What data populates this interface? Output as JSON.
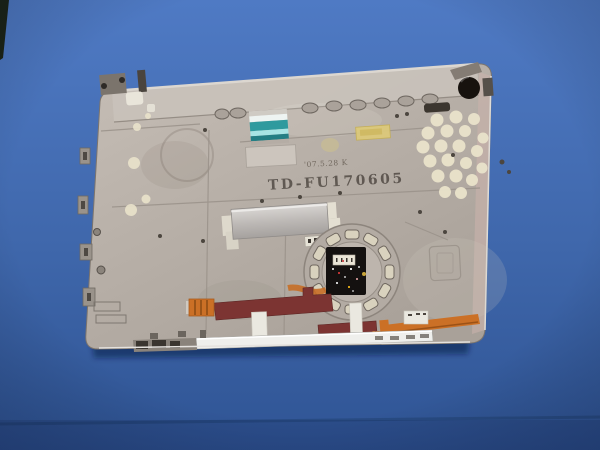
{
  "photo": {
    "subject": "laptop chassis inner panel on blue work mat",
    "stamps": {
      "date_stamp": "'07.5.28 K",
      "part_number": "TD-FU170605"
    },
    "colors": {
      "mat_blue": "#4571b5",
      "mat_seam": "#27497f",
      "chassis_silver": "#b9b1a9",
      "chassis_flange": "#c9c2ba",
      "edge_pink": "#c9b2ac",
      "adhesive_dot": "#eae3cb",
      "teal_flex": "#2f9a9e",
      "kapton_yellow": "#dcc97a",
      "maroon_flex": "#7c3432",
      "orange_flex": "#cb7026",
      "pcb_black": "#141110",
      "connector_white": "#eae5d7",
      "front_rail": "#efefec",
      "rubber_grommet": "#17120e",
      "stamp_ink": "#57504a",
      "stamp_ink_light": "#6b6258"
    }
  }
}
